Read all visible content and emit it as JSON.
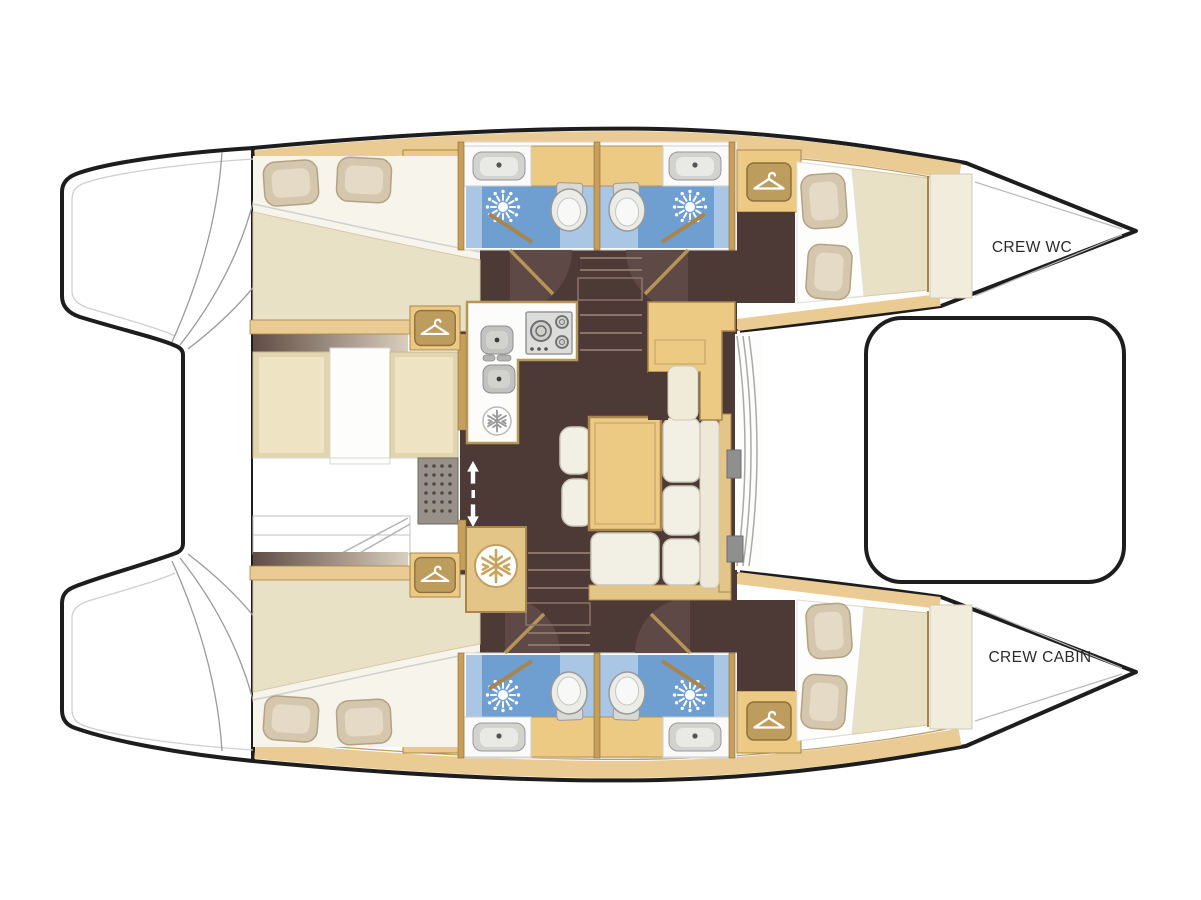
{
  "labels": {
    "crew_wc": "CREW WC",
    "crew_cabin": "CREW CABIN"
  },
  "icons": [
    {
      "name": "wardrobe-hanger-icon",
      "meaning": "wardrobe / hanging locker",
      "count": 4
    },
    {
      "name": "fridge-snowflake-icon",
      "meaning": "refrigerator / freezer",
      "count": 2
    },
    {
      "name": "shower-icon",
      "meaning": "shower head spray",
      "count": 4
    },
    {
      "name": "companionway-arrows-icon",
      "meaning": "up / down companionway",
      "count": 1
    }
  ],
  "colors": {
    "hull_outline": "#1d1d1d",
    "wood": "#ecca84",
    "wood_band": "#e9cb93",
    "wood_stroke": "#a8854d",
    "wall": "#c69f5b",
    "floor_dark": "#4d3a37",
    "floor_arc": "#5e4947",
    "bathroom_blue": "#6f9ed0",
    "bathroom_blue_light": "#a9c6e4",
    "mattress_cream": "#e9e1c6",
    "cushion_white": "#f2efe5",
    "pillow": "#d5c7ae",
    "fixture_gray": "#c9c9c9"
  }
}
